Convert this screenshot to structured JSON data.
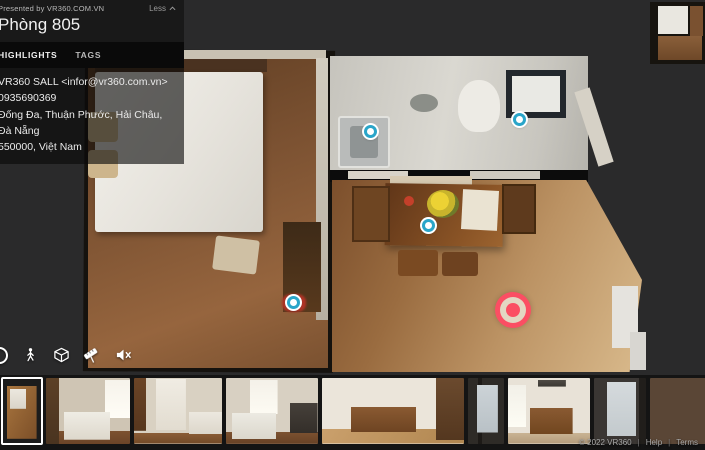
{
  "header": {
    "presented_by": "Presented by VR360.COM.VN",
    "title": "Phòng 805",
    "collapse_label": "Less",
    "tabs": [
      {
        "label": "HIGHLIGHTS",
        "active": true
      },
      {
        "label": "TAGS",
        "active": false
      }
    ],
    "contact": {
      "email": "VR360 SALL <infor@vr360.com.vn>",
      "phone": "0935690369",
      "address_line1": "Đống Đa, Thuận Phước, Hải Châu, Đà Nẵng",
      "address_line2": "550000, Việt Nam"
    }
  },
  "toolbar": {
    "icons": [
      {
        "name": "walk-mode-icon",
        "meaning": "walk through view"
      },
      {
        "name": "dollhouse-mode-icon",
        "meaning": "dollhouse 3D view"
      },
      {
        "name": "measure-icon",
        "meaning": "measurement tool"
      },
      {
        "name": "speaker-muted-icon",
        "meaning": "sound muted"
      }
    ]
  },
  "scene": {
    "view": "dollhouse-top-down",
    "rooms": [
      "bedroom",
      "living-dining",
      "bathroom"
    ],
    "hotspot_color": "#2aa5c9",
    "hotspots": [
      {
        "x": 372,
        "y": 133
      },
      {
        "x": 521,
        "y": 121
      },
      {
        "x": 430,
        "y": 227
      },
      {
        "x": 295,
        "y": 304
      }
    ],
    "reticle": {
      "x": 513,
      "y": 310,
      "color": "#fb4e63"
    }
  },
  "filmstrip": {
    "thumbnails": [
      {
        "name": "thumb-floorplan",
        "selected": true,
        "w": 40
      },
      {
        "name": "thumb-bedroom-bed",
        "selected": false,
        "w": 84
      },
      {
        "name": "thumb-bedroom-wardrobe",
        "selected": false,
        "w": 88
      },
      {
        "name": "thumb-bedroom-tv",
        "selected": false,
        "w": 92
      },
      {
        "name": "thumb-dining-table",
        "selected": false,
        "w": 142
      },
      {
        "name": "thumb-balcony-view",
        "selected": false,
        "w": 36
      },
      {
        "name": "thumb-dining-ac",
        "selected": false,
        "w": 82
      },
      {
        "name": "thumb-city-window",
        "selected": false,
        "w": 52
      },
      {
        "name": "thumb-kitchen",
        "selected": false,
        "w": 66
      }
    ]
  },
  "footer": {
    "copyright": "© 2022 VR360",
    "separator": "|",
    "links": [
      "Help",
      "Terms"
    ]
  }
}
